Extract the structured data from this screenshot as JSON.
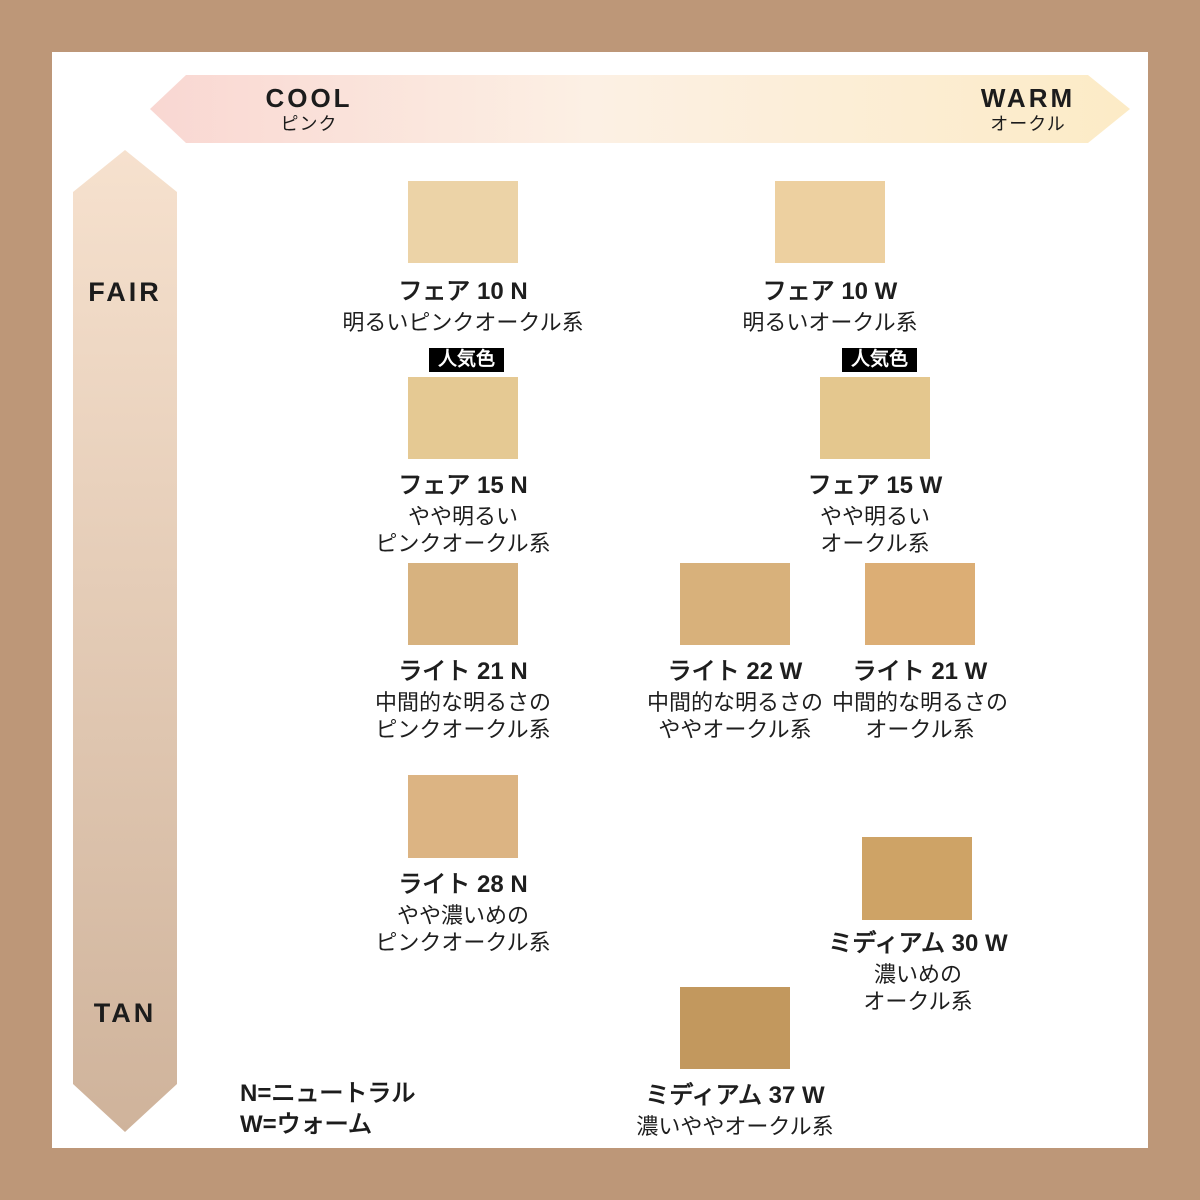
{
  "frame_color": "#bd9778",
  "axes": {
    "horizontal": {
      "left_label": "COOL",
      "left_sub": "ピンク",
      "right_label": "WARM",
      "right_sub": "オークル",
      "gradient_left": "#f9d7d2",
      "gradient_mid": "#fcf0e4",
      "gradient_right": "#fcebc6"
    },
    "vertical": {
      "top_label": "FAIR",
      "bottom_label": "TAN",
      "gradient_top": "#f6e1ce",
      "gradient_bottom": "#cfb39b"
    }
  },
  "badge_label": "人気色",
  "shades": {
    "fair10n": {
      "name": "フェア 10 N",
      "desc1": "明るいピンクオークル系",
      "color": "#ecd3a7"
    },
    "fair10w": {
      "name": "フェア 10 W",
      "desc1": "明るいオークル系",
      "color": "#edd0a0"
    },
    "fair15n": {
      "name": "フェア 15 N",
      "desc1": "やや明るい",
      "desc2": "ピンクオークル系",
      "color": "#e5c993",
      "popular": "人気色"
    },
    "fair15w": {
      "name": "フェア 15 W",
      "desc1": "やや明るい",
      "desc2": "オークル系",
      "color": "#e4c78e",
      "popular": "人気色"
    },
    "light21n": {
      "name": "ライト 21 N",
      "desc1": "中間的な明るさの",
      "desc2": "ピンクオークル系",
      "color": "#d7b27f"
    },
    "light22w": {
      "name": "ライト 22 W",
      "desc1": "中間的な明るさの",
      "desc2": "ややオークル系",
      "color": "#d8b17b"
    },
    "light21w": {
      "name": "ライト 21 W",
      "desc1": "中間的な明るさの",
      "desc2": "オークル系",
      "color": "#dcae75"
    },
    "light28n": {
      "name": "ライト 28 N",
      "desc1": "やや濃いめの",
      "desc2": "ピンクオークル系",
      "color": "#dcb483"
    },
    "medium30w": {
      "name": "ミディアム 30 W",
      "desc1": "濃いめの",
      "desc2": "オークル系",
      "color": "#cea366"
    },
    "medium37w": {
      "name": "ミディアム 37 W",
      "desc1": "濃いややオークル系",
      "color": "#c2985e"
    }
  },
  "legend": {
    "line1": "N=ニュートラル",
    "line2": "W=ウォーム"
  }
}
